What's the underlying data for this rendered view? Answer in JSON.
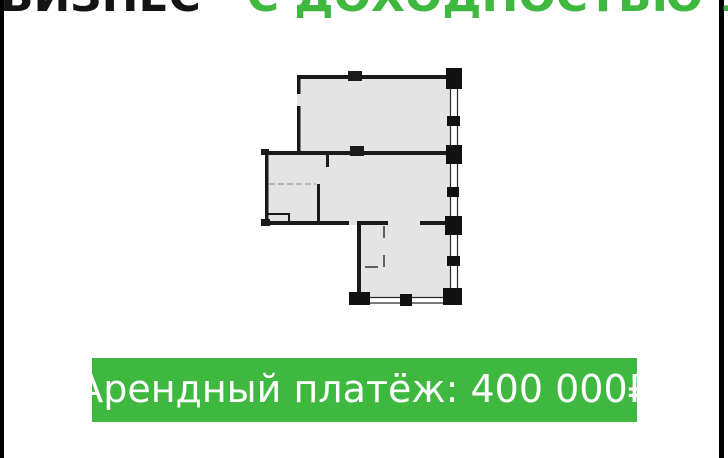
{
  "title": {
    "prefix": "БИЗНЕС",
    "highlight": "С ДОХОДНОСТЬЮ 15%"
  },
  "banner": {
    "text": "Арендный платёж: 400 000₽"
  },
  "floorplan": {
    "description": "commercial unit floor plan",
    "floor_color": "#e4e4e4",
    "wall_color": "#1a1a1a",
    "window_line_color": "#2a2a2a"
  },
  "colors": {
    "accent_green": "#3FB840",
    "title_black": "#141414",
    "banner_text": "#ffffff",
    "edge_bar": "#000000"
  }
}
